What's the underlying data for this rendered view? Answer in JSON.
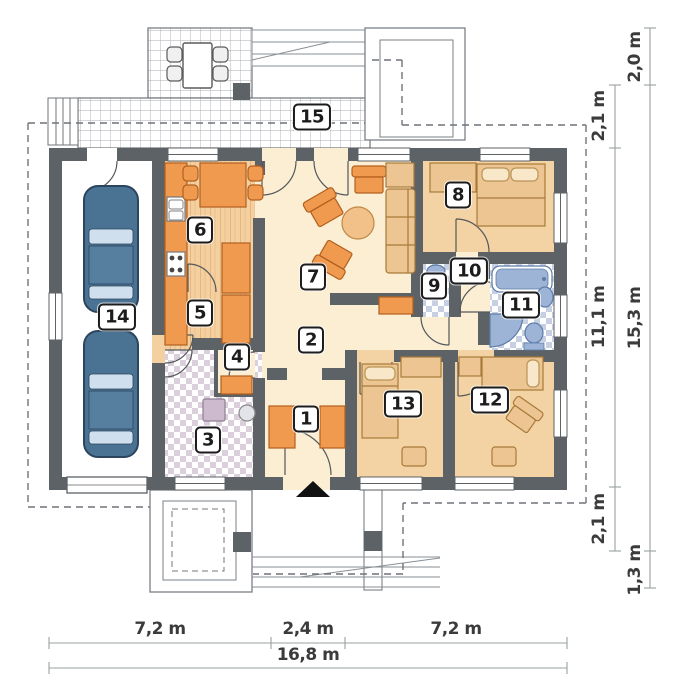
{
  "plan_title": "Single-storey house floor plan",
  "rooms": [
    {
      "number": "1"
    },
    {
      "number": "2"
    },
    {
      "number": "3"
    },
    {
      "number": "4"
    },
    {
      "number": "5"
    },
    {
      "number": "6"
    },
    {
      "number": "7"
    },
    {
      "number": "8"
    },
    {
      "number": "9"
    },
    {
      "number": "10"
    },
    {
      "number": "11"
    },
    {
      "number": "12"
    },
    {
      "number": "13"
    },
    {
      "number": "14"
    },
    {
      "number": "15"
    }
  ],
  "dimensions": {
    "bottom": [
      "7,2 m",
      "2,4 m",
      "7,2 m",
      "16,8 m"
    ],
    "right_inner": [
      "2,1 m",
      "11,1 m",
      "2,1 m"
    ],
    "right_outer": [
      "2,0 m",
      "15,3 m",
      "1,3 m"
    ]
  },
  "colors": {
    "wall": "#5d6266",
    "floor_cream": "#fbeed2",
    "floor_bedroom": "#f3d3a3",
    "floor_wood": "#f4cf9f",
    "furniture_orange": "#f09a50",
    "furniture_tan": "#ecc592",
    "fixture_blue": "#9db4d6",
    "car_blue": "#4a7292",
    "tile_blue": "#c6d0e2",
    "tile_mauve": "#dacfdb"
  }
}
